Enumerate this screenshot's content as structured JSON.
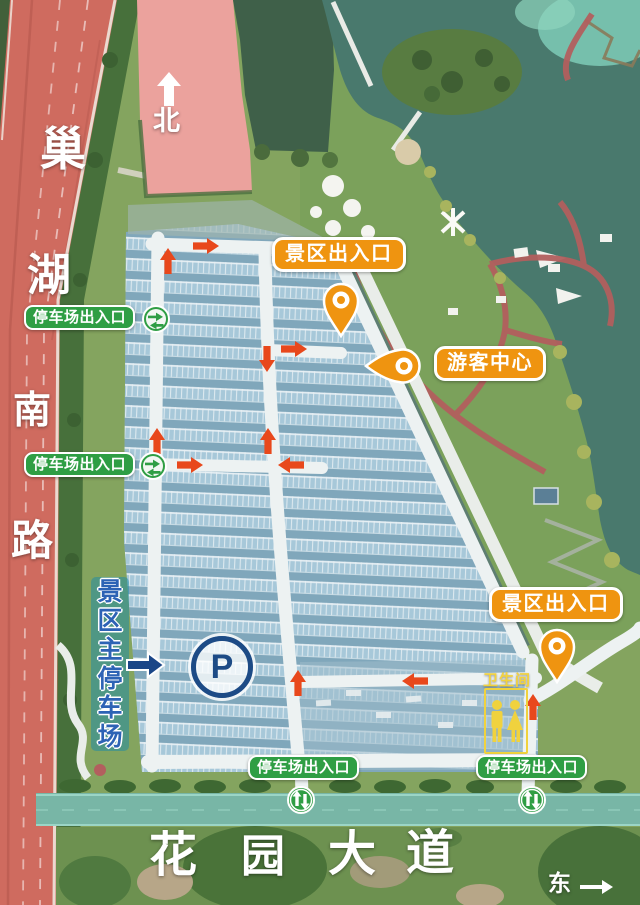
{
  "map": {
    "compass": {
      "north": "北",
      "east": "东"
    },
    "roads": {
      "left_road_name": "巢湖南路",
      "left_road_chars": [
        "巢",
        "湖",
        "南",
        "路"
      ],
      "bottom_road_name": "花园大道",
      "bottom_road_chars": [
        "花",
        "园",
        "大",
        "道"
      ]
    },
    "labels": {
      "scenic_entrance": "景区出入口",
      "visitor_center": "游客中心",
      "parking_entrance": "停车场出入口",
      "main_parking_name": "景区主停车场",
      "main_parking_chars": [
        "景",
        "区",
        "主",
        "停",
        "车",
        "场"
      ],
      "restroom": "卫生间",
      "parking_symbol": "P"
    },
    "colors": {
      "accent_orange": "#ef9410",
      "accent_green": "#2f9e44",
      "drive_arrow_red": "#e8481c",
      "parking_navy": "#1d4b86",
      "main_parking_text_blue": "#2d63b5",
      "highlight_teal": "#5ec6ae",
      "road_red": "#cf6b5f",
      "parking_field_blue": "#8fb4c7",
      "lake_teal": "#49796d",
      "pink_field": "#eba29d",
      "restroom_yellow": "#f0d23e"
    }
  }
}
